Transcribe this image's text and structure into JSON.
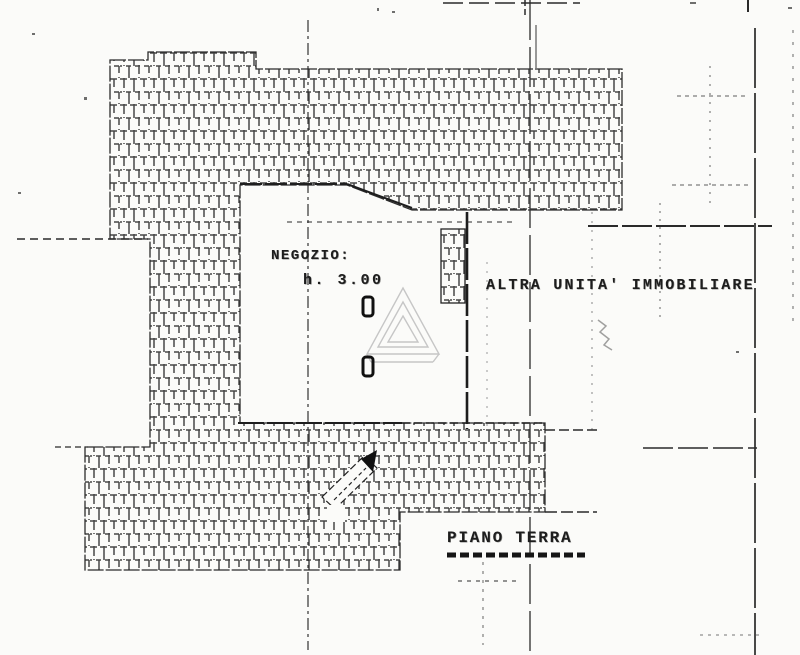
{
  "labels": {
    "room": "NEGOZIO:",
    "room_height": "h. 3.00",
    "adjacent_unit": "ALTRA UNITA' IMMOBILIARE",
    "floor": "PIANO TERRA"
  },
  "colors": {
    "ink": "#1d1d1d",
    "paper": "#fbfbf9",
    "watermark": "#c6c6c6"
  }
}
